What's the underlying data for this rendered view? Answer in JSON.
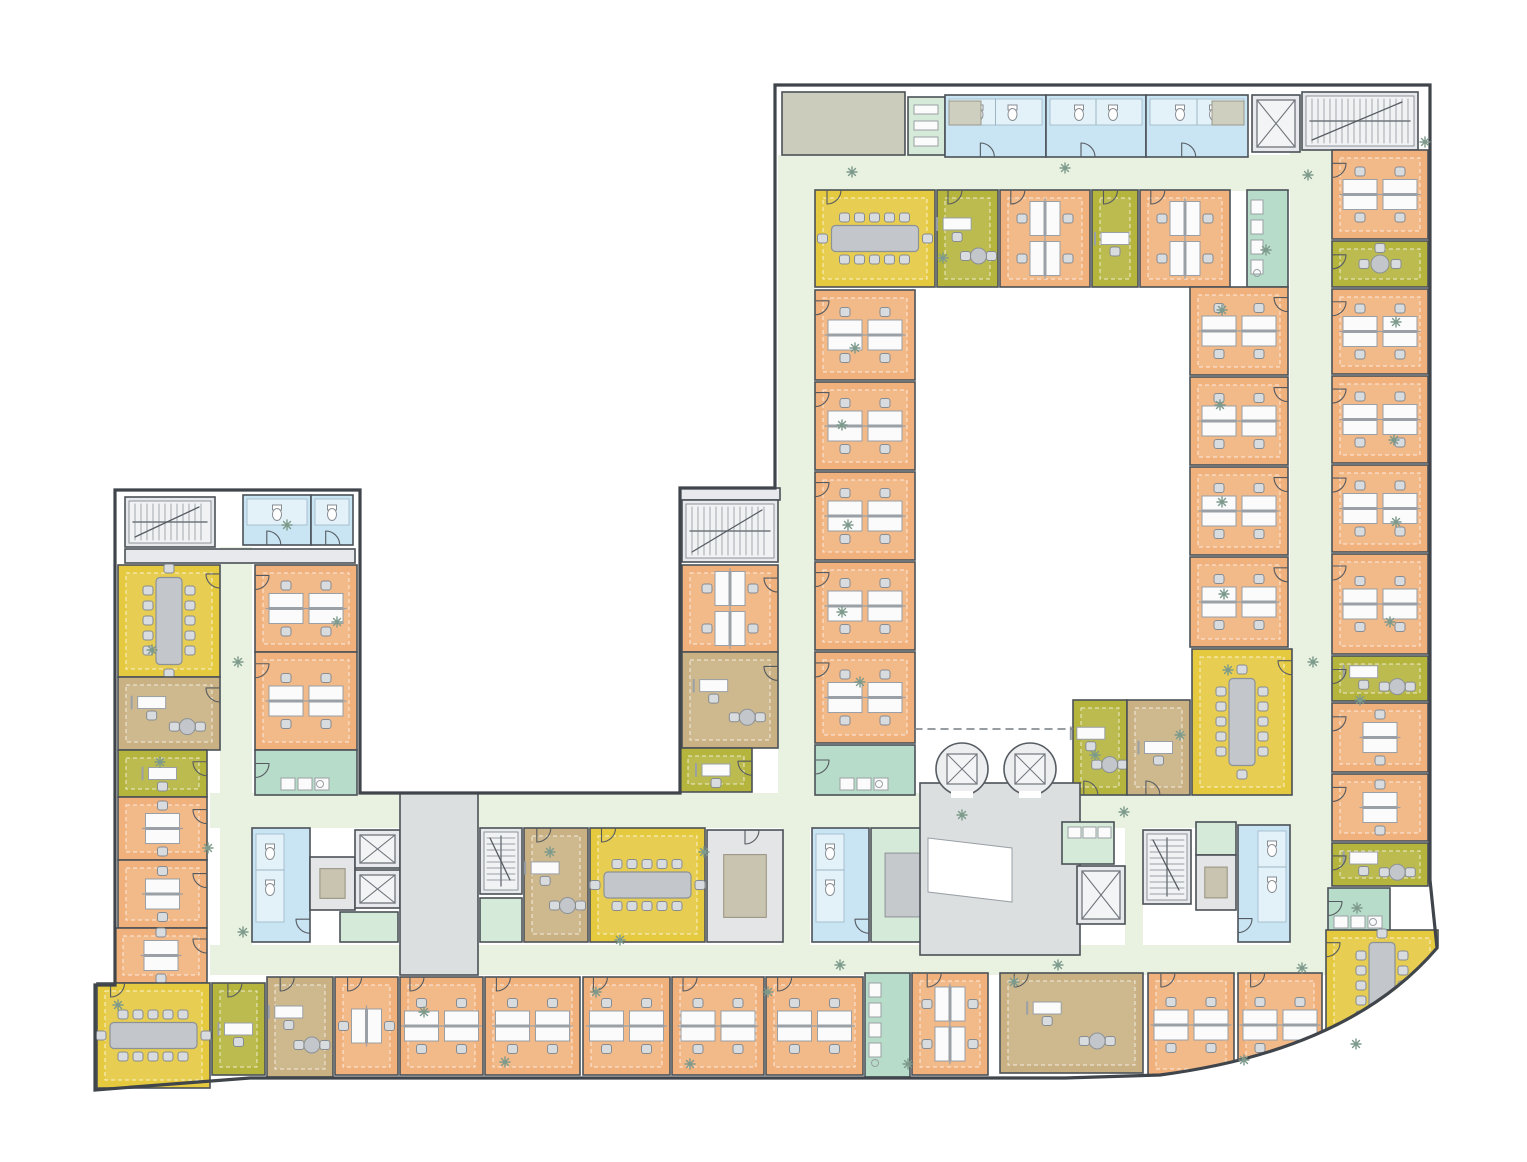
{
  "canvas": {
    "w": 1527,
    "h": 1162
  },
  "palette": {
    "wall": "#4b5157",
    "outline": "#3f454b",
    "corridor": "#e9f2e0",
    "courtyard": "#ffffff",
    "office": "#f1b17c",
    "meeting": "#e5c93f",
    "olive": "#b5b43c",
    "tan": "#c9b183",
    "wc": "#c9e4f3",
    "pantry": "#b7dcc9",
    "mint": "#d5ead9",
    "core": "#e7e9ec",
    "storage": "#e3e5e7",
    "lobby": "#dcdfdf",
    "terrace": "#cbccbc",
    "desk": "#fbfbfb",
    "deskline": "#9aa0a5",
    "table": "#c3c7cb",
    "tableline": "#8d9297",
    "chair": "#d9dcdf",
    "chairline": "#878c91",
    "stair": "#f0f2f4",
    "lift": "#f3f4f6",
    "tanbox": "#c9c4b0",
    "graybox": "#c6c9cb",
    "plant": "#7d9a8c",
    "fixture": "#ffffff",
    "door": "#555a60"
  },
  "outline_path": "M775,85 L1430,85 L1430,880 L1437,948 Q1350,1050 1160,1075 L1065,1078 L340,1078 L250,1078 L95,1090 L95,985 L115,985 L115,490 L360,490 L360,793 L680,793 L680,488 L775,488 Z",
  "se_mask_path": "M1005,1094 L1465,1094 L1465,940 L1437,948 Q1350,1050 1160,1075 L1065,1078 L1005,1080 Z",
  "corridors": [
    [
      778,
      155,
      642,
      36
    ],
    [
      778,
      191,
      37,
      602
    ],
    [
      1290,
      150,
      42,
      797
    ],
    [
      210,
      793,
      712,
      35
    ],
    [
      1080,
      793,
      210,
      35
    ],
    [
      210,
      945,
      1124,
      30
    ],
    [
      220,
      547,
      32,
      400
    ],
    [
      782,
      828,
      28,
      117
    ],
    [
      1125,
      828,
      18,
      117
    ]
  ],
  "lobby_void": [
    [
      928,
      838
    ],
    [
      1012,
      848
    ],
    [
      1012,
      902
    ],
    [
      928,
      892
    ]
  ],
  "dashed_line": [
    915,
    729,
    1073,
    729
  ],
  "round_lifts": [
    [
      962,
      769
    ],
    [
      1030,
      769
    ]
  ],
  "rooms": [
    [
      "terrace",
      782,
      92,
      123,
      63,
      "none",
      ""
    ],
    [
      "mint",
      908,
      97,
      37,
      58,
      "shf",
      ""
    ],
    [
      "wc",
      945,
      95,
      101,
      62,
      "wcTL",
      ""
    ],
    [
      "wc",
      1046,
      95,
      100,
      62,
      "wcT",
      ""
    ],
    [
      "wc",
      1146,
      95,
      102,
      62,
      "wcTR",
      ""
    ],
    [
      "core",
      1252,
      95,
      48,
      57,
      "lift",
      ""
    ],
    [
      "core",
      1302,
      92,
      116,
      58,
      "stH",
      ""
    ],
    [
      "meeting",
      815,
      190,
      120,
      97,
      "confH5",
      "T0.10"
    ],
    [
      "olive",
      937,
      190,
      61,
      97,
      "dR",
      "T0.18"
    ],
    [
      "office",
      1000,
      190,
      90,
      97,
      "d4V",
      "T0.12"
    ],
    [
      "olive",
      1092,
      190,
      46,
      97,
      "d1",
      "T0.25"
    ],
    [
      "office",
      1140,
      190,
      90,
      97,
      "d4V",
      "T0.12"
    ],
    [
      "pantry",
      1247,
      190,
      41,
      97,
      "cntV",
      ""
    ],
    [
      "office",
      815,
      290,
      100,
      90,
      "d4H",
      "L0.12"
    ],
    [
      "office",
      815,
      382,
      100,
      88,
      "d4H",
      "L0.12"
    ],
    [
      "office",
      815,
      472,
      100,
      88,
      "d4H",
      "L0.12"
    ],
    [
      "office",
      815,
      562,
      100,
      88,
      "d4H",
      "L0.12"
    ],
    [
      "office",
      815,
      652,
      100,
      91,
      "d4H",
      "L0.12"
    ],
    [
      "pantry",
      815,
      745,
      100,
      50,
      "cntB",
      "L0.3"
    ],
    [
      "office",
      1190,
      287,
      98,
      88,
      "d4H",
      "R0.12"
    ],
    [
      "office",
      1190,
      377,
      98,
      88,
      "d4H",
      "R0.12"
    ],
    [
      "office",
      1190,
      467,
      98,
      88,
      "d4H",
      "R0.12"
    ],
    [
      "office",
      1190,
      557,
      98,
      90,
      "d4H",
      "R0.12"
    ],
    [
      "meeting",
      1192,
      649,
      100,
      146,
      "confV5",
      "R0.08"
    ],
    [
      "olive",
      1073,
      700,
      54,
      95,
      "dR",
      "B0.2"
    ],
    [
      "tan",
      1127,
      700,
      63,
      95,
      "d1",
      "B0.3"
    ],
    [
      "office",
      1332,
      150,
      96,
      89,
      "d4H",
      "L0.15"
    ],
    [
      "olive",
      1332,
      241,
      96,
      46,
      "rnd",
      "L0.3"
    ],
    [
      "office",
      1332,
      289,
      96,
      85,
      "d4H",
      "L0.15"
    ],
    [
      "office",
      1332,
      376,
      96,
      87,
      "d4H",
      "L0.15"
    ],
    [
      "office",
      1332,
      465,
      96,
      87,
      "d4H",
      "L0.15"
    ],
    [
      "office",
      1332,
      554,
      96,
      100,
      "d4H",
      "L0.12"
    ],
    [
      "olive",
      1332,
      656,
      96,
      45,
      "dR",
      "L0.3"
    ],
    [
      "office",
      1332,
      703,
      96,
      69,
      "d2H",
      "L0.2"
    ],
    [
      "office",
      1332,
      774,
      96,
      67,
      "d2H",
      "L0.2"
    ],
    [
      "olive",
      1332,
      843,
      96,
      43,
      "dR",
      "L0.3"
    ],
    [
      "pantry",
      1328,
      888,
      62,
      45,
      "cntB",
      "L0.3"
    ],
    [
      "core",
      125,
      497,
      90,
      50,
      "stH",
      ""
    ],
    [
      "wc",
      243,
      495,
      68,
      50,
      "wcT",
      ""
    ],
    [
      "wc",
      311,
      495,
      42,
      50,
      "wcT",
      ""
    ],
    [
      "core",
      125,
      549,
      230,
      14,
      "none",
      ""
    ],
    [
      "meeting",
      118,
      565,
      102,
      112,
      "confV5",
      "R0.08"
    ],
    [
      "tan",
      118,
      677,
      102,
      73,
      "dR",
      "R0.15"
    ],
    [
      "olive",
      118,
      750,
      89,
      47,
      "d1",
      "R0.25"
    ],
    [
      "office",
      118,
      797,
      89,
      63,
      "d2H",
      "R0.2"
    ],
    [
      "office",
      118,
      860,
      89,
      68,
      "d2H",
      "R0.2"
    ],
    [
      "office",
      115,
      928,
      92,
      55,
      "d2H",
      "R0.2"
    ],
    [
      "office",
      255,
      565,
      102,
      87,
      "d4H",
      "L0.12"
    ],
    [
      "office",
      255,
      652,
      102,
      98,
      "d4H",
      "L0.12"
    ],
    [
      "pantry",
      255,
      750,
      102,
      45,
      "cntB",
      "L0.3"
    ],
    [
      "core",
      680,
      488,
      100,
      12,
      "none",
      ""
    ],
    [
      "core",
      682,
      500,
      96,
      62,
      "stH",
      ""
    ],
    [
      "office",
      682,
      565,
      96,
      87,
      "d4V",
      "R0.15"
    ],
    [
      "tan",
      682,
      652,
      96,
      96,
      "dR",
      "R0.15"
    ],
    [
      "olive",
      680,
      748,
      72,
      44,
      "d1",
      "R0.3"
    ],
    [
      "wc",
      252,
      828,
      58,
      114,
      "wcL",
      ""
    ],
    [
      "storage",
      310,
      857,
      45,
      53,
      "tanbox",
      ""
    ],
    [
      "core",
      355,
      830,
      45,
      38,
      "lift",
      ""
    ],
    [
      "core",
      355,
      870,
      45,
      38,
      "lift",
      ""
    ],
    [
      "mint",
      340,
      912,
      58,
      30,
      "none",
      ""
    ],
    [
      "lobby",
      400,
      793,
      78,
      182,
      "none",
      ""
    ],
    [
      "core",
      480,
      828,
      42,
      66,
      "stV",
      ""
    ],
    [
      "mint",
      480,
      898,
      42,
      44,
      "none",
      ""
    ],
    [
      "tan",
      524,
      828,
      64,
      114,
      "dR",
      "T0.2"
    ],
    [
      "meeting",
      590,
      828,
      115,
      114,
      "confH5",
      "T0.1"
    ],
    [
      "storage",
      707,
      830,
      76,
      112,
      "tanbox",
      "T0.5"
    ],
    [
      "wc",
      812,
      828,
      57,
      114,
      "wcL",
      ""
    ],
    [
      "mint",
      871,
      828,
      64,
      114,
      "graybox",
      ""
    ],
    [
      "lobby",
      920,
      783,
      160,
      172,
      "none",
      ""
    ],
    [
      "mint",
      1062,
      822,
      52,
      42,
      "cntH",
      ""
    ],
    [
      "core",
      1077,
      866,
      48,
      58,
      "lift",
      ""
    ],
    [
      "core",
      1143,
      830,
      48,
      74,
      "stV",
      ""
    ],
    [
      "mint",
      1196,
      822,
      40,
      33,
      "none",
      ""
    ],
    [
      "storage",
      1196,
      855,
      40,
      55,
      "tanbox",
      ""
    ],
    [
      "wc",
      1238,
      825,
      52,
      117,
      "wcR",
      ""
    ],
    [
      "meeting",
      97,
      983,
      113,
      105,
      "confH5",
      "T0.12"
    ],
    [
      "olive",
      212,
      983,
      53,
      92,
      "d1",
      "T0.3"
    ],
    [
      "tan",
      267,
      977,
      66,
      100,
      "dR",
      "T0.2"
    ],
    [
      "office",
      335,
      977,
      63,
      98,
      "d2V",
      "T0.2"
    ],
    [
      "office",
      400,
      977,
      83,
      98,
      "d4H",
      "T0.12"
    ],
    [
      "office",
      485,
      977,
      95,
      98,
      "d4H",
      "T0.12"
    ],
    [
      "office",
      583,
      977,
      87,
      98,
      "d4H",
      "T0.12"
    ],
    [
      "office",
      672,
      977,
      92,
      98,
      "d4H",
      "T0.12"
    ],
    [
      "office",
      766,
      977,
      97,
      98,
      "d4H",
      "T0.12"
    ],
    [
      "pantry",
      865,
      973,
      45,
      104,
      "cntV",
      ""
    ],
    [
      "office",
      912,
      973,
      76,
      102,
      "d4V",
      "T0.2"
    ],
    [
      "tan",
      1000,
      973,
      143,
      100,
      "dR",
      "T0.1"
    ],
    [
      "office",
      1148,
      973,
      86,
      104,
      "d4H",
      "T0.15"
    ],
    [
      "office",
      1238,
      973,
      84,
      104,
      "d4H",
      "T0.15"
    ],
    [
      "meeting",
      1326,
      930,
      112,
      127,
      "confV6",
      "L0.1"
    ]
  ],
  "plants": [
    [
      852,
      172
    ],
    [
      1065,
      168
    ],
    [
      1308,
      175
    ],
    [
      1425,
      142
    ],
    [
      943,
      258
    ],
    [
      1266,
      250
    ],
    [
      855,
      348
    ],
    [
      1222,
      310
    ],
    [
      1396,
      322
    ],
    [
      842,
      425
    ],
    [
      1220,
      405
    ],
    [
      1394,
      440
    ],
    [
      848,
      525
    ],
    [
      1222,
      502
    ],
    [
      1396,
      522
    ],
    [
      842,
      612
    ],
    [
      1224,
      594
    ],
    [
      1390,
      622
    ],
    [
      860,
      682
    ],
    [
      1228,
      670
    ],
    [
      1313,
      662
    ],
    [
      1360,
      700
    ],
    [
      152,
      650
    ],
    [
      238,
      662
    ],
    [
      160,
      762
    ],
    [
      208,
      848
    ],
    [
      243,
      932
    ],
    [
      287,
      525
    ],
    [
      337,
      622
    ],
    [
      424,
      1012
    ],
    [
      505,
      1062
    ],
    [
      596,
      992
    ],
    [
      690,
      1064
    ],
    [
      768,
      992
    ],
    [
      908,
      1064
    ],
    [
      1014,
      982
    ],
    [
      1244,
      1060
    ],
    [
      1356,
      1044
    ],
    [
      550,
      852
    ],
    [
      704,
      852
    ],
    [
      962,
      815
    ],
    [
      1124,
      812
    ],
    [
      1357,
      908
    ],
    [
      620,
      940
    ],
    [
      840,
      965
    ],
    [
      1058,
      965
    ],
    [
      1302,
      968
    ],
    [
      118,
      1005
    ],
    [
      1180,
      735
    ],
    [
      1095,
      755
    ]
  ]
}
